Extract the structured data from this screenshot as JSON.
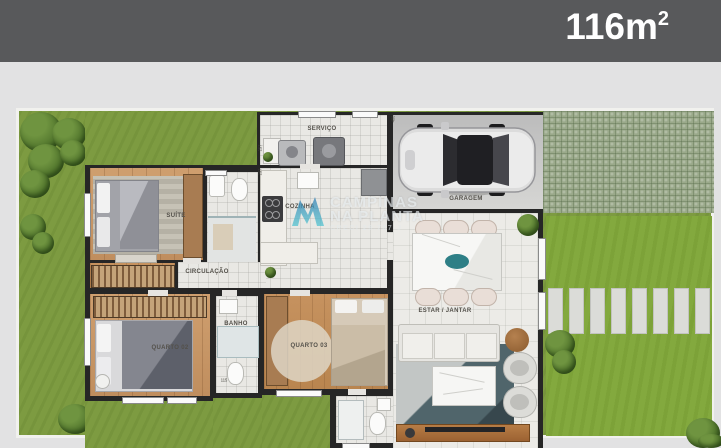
{
  "header": {
    "area_value": "116m",
    "area_exponent": "2"
  },
  "watermark": {
    "brand_line1": "CAMPINAS",
    "brand_line2": "NA PLANTA",
    "creci": "CRECI 29.707-J",
    "logo_color_top": "#2b7ab2",
    "logo_color_bottom": "#4fc3cf"
  },
  "rooms": {
    "servico": "SERVIÇO",
    "garagem": "GARAGEM",
    "suite": "SUÍTE",
    "cozinha": "COZINHA",
    "circulacao": "CIRCULAÇÃO",
    "quarto02": "QUARTO 02",
    "banho": "BANHO",
    "quarto03": "QUARTO 03",
    "estar_jantar": "ESTAR / JANTAR"
  },
  "dimensions": {
    "d400": "400",
    "d257a": "257",
    "d257b": "257",
    "d115": "115"
  },
  "colors": {
    "header_bar": "#58595b",
    "grass": "#7d9b41",
    "wall": "#262626",
    "wood_floor": "#c89a6d",
    "driveway": "#9aa98a"
  }
}
